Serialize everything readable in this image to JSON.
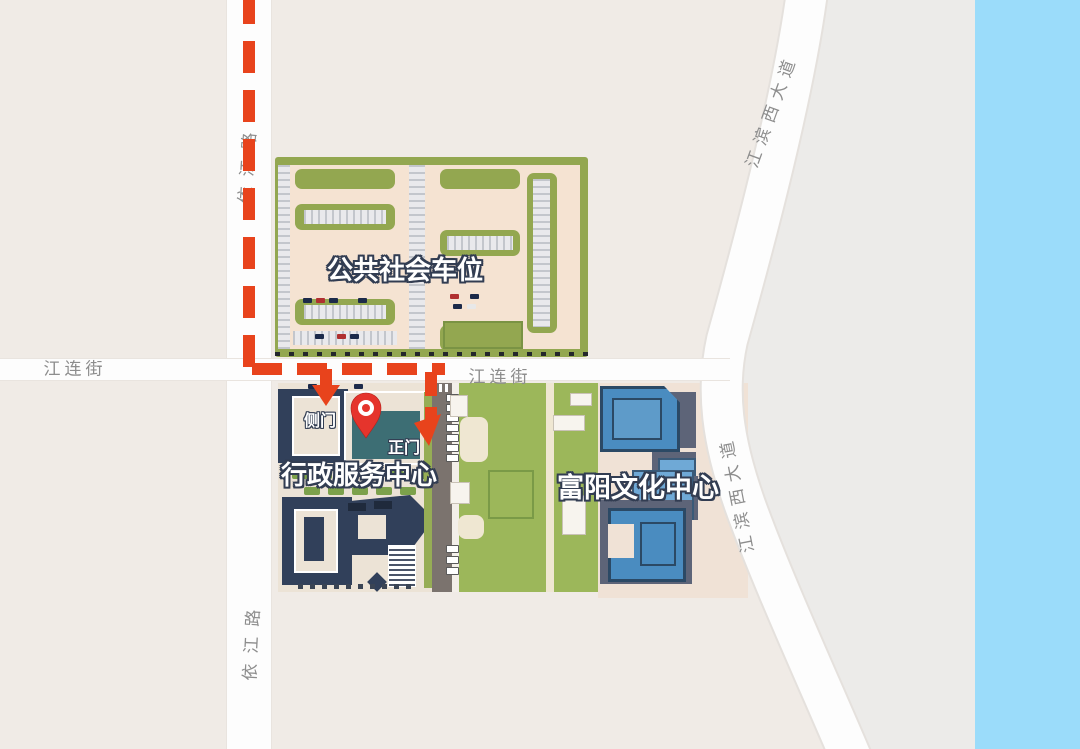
{
  "colors": {
    "background": "#f0ebe6",
    "river": "#9bdcfa",
    "route": "#e8431c",
    "pin": "#e5342c",
    "road": "#fdfdfd",
    "parking_green": "#93a750",
    "lawn_green": "#9cb75a",
    "admin_navy": "#31405a",
    "cultural_blue": "#4a8cc0",
    "plaza": "#f0e2d6"
  },
  "areas": {
    "parking": {
      "label": "公共社会车位"
    },
    "admin_center": {
      "label": "行政服务中心",
      "side_gate": "侧门",
      "main_gate": "正门"
    },
    "cultural_center": {
      "label": "富阳文化中心"
    }
  },
  "roads": {
    "yijiang_road": {
      "label": "依江路"
    },
    "jianglian_street": {
      "label": "江连街"
    },
    "jiangbin_west_avenue": {
      "label": "江滨西大道"
    }
  },
  "marker": {
    "name": "destination-pin"
  },
  "route": {
    "style": "red-dashed",
    "arrows": [
      "side-gate-arrow",
      "main-gate-arrow"
    ]
  }
}
